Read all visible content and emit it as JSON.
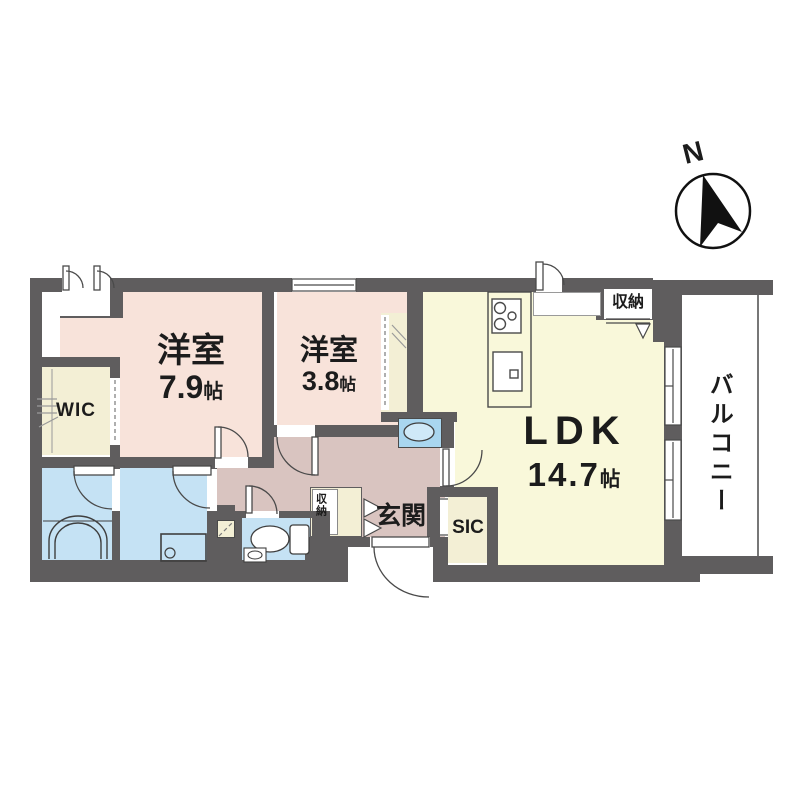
{
  "compass": {
    "label": "N"
  },
  "rooms": {
    "bedroom_main": {
      "name": "洋室",
      "size_value": "7.9",
      "size_unit": "帖"
    },
    "bedroom_second": {
      "name": "洋室",
      "size_value": "3.8",
      "size_unit": "帖"
    },
    "ldk": {
      "name": "LDK",
      "size_value": "14.7",
      "size_unit": "帖"
    },
    "wic": {
      "label": "WIC"
    },
    "sic": {
      "label": "SIC"
    },
    "entrance": {
      "label": "玄関"
    },
    "balcony": {
      "label": "バルコニー"
    },
    "kitchen_storage": {
      "label": "収納"
    },
    "hall_storage": {
      "label": "収納"
    }
  },
  "colors": {
    "wall": "#5f5d5e",
    "bedroom_floor": "#f8e3da",
    "hallway_floor": "#d9c4c0",
    "ldk_floor": "#f9f8da",
    "closet_floor": "#f3efd5",
    "wet_area_floor": "#c5e2f4",
    "fixture_blue": "#a9d6ef"
  }
}
